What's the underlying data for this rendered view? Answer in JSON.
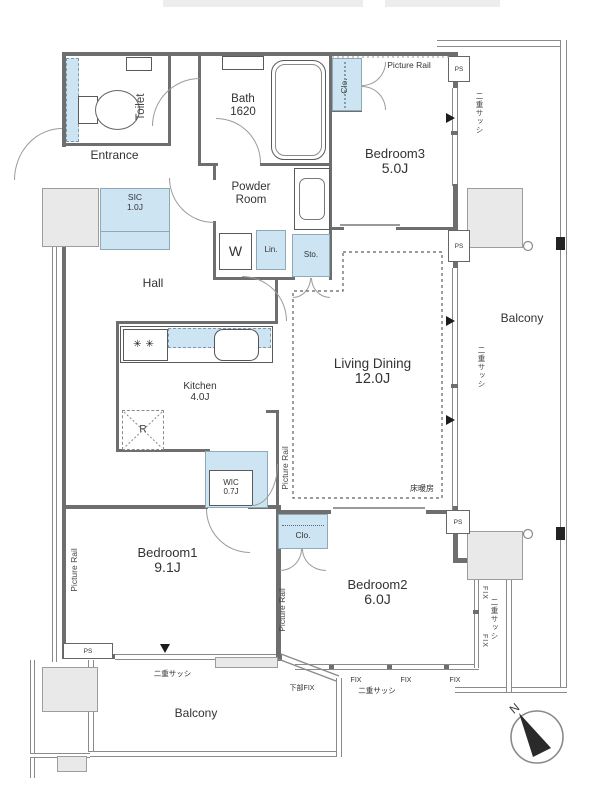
{
  "rooms": {
    "toilet": {
      "name": "Toilet"
    },
    "entrance": {
      "name": "Entrance"
    },
    "sic": {
      "name": "SIC",
      "size": "1.0J"
    },
    "hall": {
      "name": "Hall"
    },
    "bath": {
      "name": "Bath",
      "size": "1620"
    },
    "powder_room": {
      "line1": "Powder",
      "line2": "Room"
    },
    "washer": {
      "name": "W"
    },
    "linen": {
      "name": "Lin."
    },
    "storage": {
      "name": "Sto."
    },
    "closet": {
      "name": "Clo."
    },
    "bedroom3": {
      "name": "Bedroom3",
      "size": "5.0J"
    },
    "living_dining": {
      "name": "Living Dining",
      "size": "12.0J"
    },
    "kitchen": {
      "name": "Kitchen",
      "size": "4.0J"
    },
    "refrigerator": {
      "name": "R"
    },
    "wic": {
      "name": "WIC",
      "size": "0.7J"
    },
    "bedroom1": {
      "name": "Bedroom1",
      "size": "9.1J"
    },
    "bedroom2": {
      "name": "Bedroom2",
      "size": "6.0J"
    },
    "balcony": {
      "name": "Balcony"
    }
  },
  "labels": {
    "ps": "PS",
    "picture_rail": "Picture Rail",
    "double_sash": "二重サッシ",
    "fix": "FIX",
    "lower_fix": "下部FIX",
    "floor_heating": "床暖房",
    "north": "N"
  },
  "colors": {
    "wall": "#6e6e6e",
    "storage_fill": "#cde5f2",
    "concrete_fill": "#e9e9e9",
    "marker": "#1c1c1c"
  }
}
